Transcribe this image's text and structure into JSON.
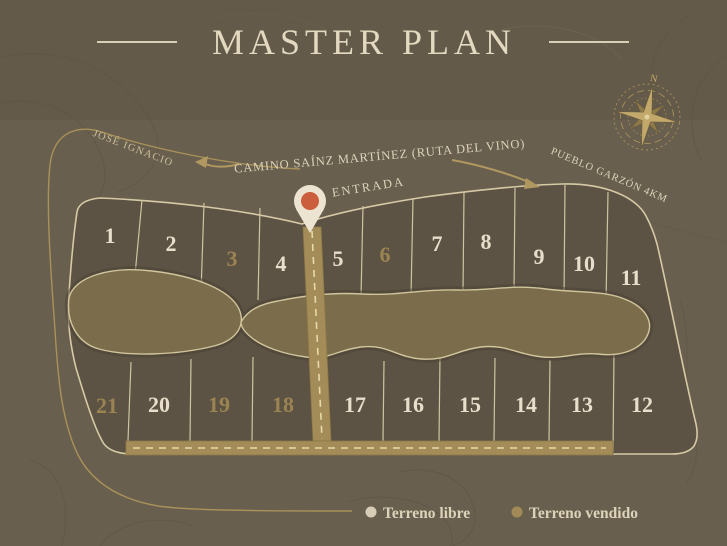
{
  "title": {
    "text": "MASTER PLAN"
  },
  "compass": {
    "north": "N"
  },
  "map": {
    "entrance_label": "ENTRADA",
    "entrance_pin_color": "#cb5f3d",
    "roads": {
      "main": "CAMINO SAÍNZ MARTÍNEZ  (RUTA DEL VINO)",
      "west_destination": "JOSÉ IGNACIO",
      "east_destination": "PUEBLO GARZÓN 4KM"
    },
    "lots": {
      "free_color": "#e8decb",
      "sold_color": "#9c8452",
      "items": [
        {
          "number": "1",
          "status": "libre"
        },
        {
          "number": "2",
          "status": "libre"
        },
        {
          "number": "3",
          "status": "vendido"
        },
        {
          "number": "4",
          "status": "libre"
        },
        {
          "number": "5",
          "status": "libre"
        },
        {
          "number": "6",
          "status": "vendido"
        },
        {
          "number": "7",
          "status": "libre"
        },
        {
          "number": "8",
          "status": "libre"
        },
        {
          "number": "9",
          "status": "libre"
        },
        {
          "number": "10",
          "status": "libre"
        },
        {
          "number": "11",
          "status": "libre"
        },
        {
          "number": "12",
          "status": "libre"
        },
        {
          "number": "13",
          "status": "libre"
        },
        {
          "number": "14",
          "status": "libre"
        },
        {
          "number": "15",
          "status": "libre"
        },
        {
          "number": "16",
          "status": "libre"
        },
        {
          "number": "17",
          "status": "libre"
        },
        {
          "number": "18",
          "status": "vendido"
        },
        {
          "number": "19",
          "status": "vendido"
        },
        {
          "number": "20",
          "status": "libre"
        },
        {
          "number": "21",
          "status": "vendido"
        }
      ]
    }
  },
  "legend": {
    "free": {
      "label": "Terreno libre",
      "color": "#d7cdb7"
    },
    "sold": {
      "label": "Terreno vendido",
      "color": "#a18a55"
    }
  }
}
